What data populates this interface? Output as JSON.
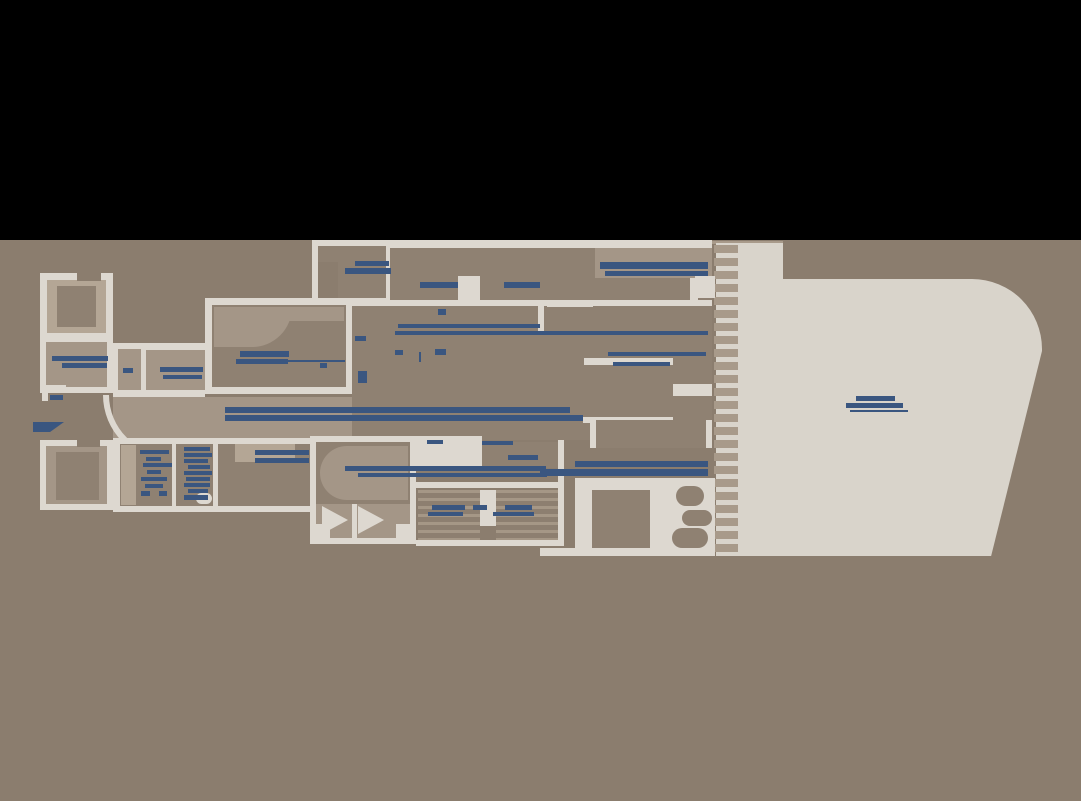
{
  "plan": {
    "kind": "deck-plan-drawing",
    "readable_text": "",
    "note_label_text_illegible": true
  },
  "colors": {
    "black": "#000000",
    "field": "#8b7d6e",
    "wall": "#ddd8d0",
    "deck": "#d9d4cb",
    "floor-a": "#92846f",
    "floor-a2": "#8f8172",
    "floor-b": "#a49687",
    "floor-c": "#b4a695",
    "tape": "#a89a8a",
    "accent": "#3a5680"
  },
  "label_bars": [
    {
      "x": 52,
      "y": 356,
      "w": 56,
      "h": 5
    },
    {
      "x": 62,
      "y": 363,
      "w": 45,
      "h": 5
    },
    {
      "x": 123,
      "y": 368,
      "w": 10,
      "h": 5
    },
    {
      "x": 160,
      "y": 367,
      "w": 43,
      "h": 5
    },
    {
      "x": 163,
      "y": 375,
      "w": 39,
      "h": 4
    },
    {
      "x": 50,
      "y": 395,
      "w": 13,
      "h": 5
    },
    {
      "x": 33,
      "y": 422,
      "w": 31,
      "h": 10,
      "slant": true
    },
    {
      "x": 240,
      "y": 351,
      "w": 49,
      "h": 6
    },
    {
      "x": 236,
      "y": 359,
      "w": 52,
      "h": 5
    },
    {
      "x": 288,
      "y": 360,
      "w": 57,
      "h": 2
    },
    {
      "x": 355,
      "y": 261,
      "w": 34,
      "h": 5
    },
    {
      "x": 345,
      "y": 268,
      "w": 46,
      "h": 6
    },
    {
      "x": 600,
      "y": 262,
      "w": 108,
      "h": 7
    },
    {
      "x": 605,
      "y": 271,
      "w": 103,
      "h": 5
    },
    {
      "x": 420,
      "y": 282,
      "w": 38,
      "h": 6
    },
    {
      "x": 504,
      "y": 282,
      "w": 36,
      "h": 6
    },
    {
      "x": 398,
      "y": 324,
      "w": 142,
      "h": 4
    },
    {
      "x": 395,
      "y": 331,
      "w": 313,
      "h": 4
    },
    {
      "x": 438,
      "y": 309,
      "w": 8,
      "h": 6
    },
    {
      "x": 355,
      "y": 336,
      "w": 11,
      "h": 5
    },
    {
      "x": 395,
      "y": 350,
      "w": 8,
      "h": 5
    },
    {
      "x": 435,
      "y": 349,
      "w": 11,
      "h": 6
    },
    {
      "x": 419,
      "y": 352,
      "w": 2,
      "h": 10
    },
    {
      "x": 358,
      "y": 371,
      "w": 9,
      "h": 12
    },
    {
      "x": 320,
      "y": 363,
      "w": 7,
      "h": 5
    },
    {
      "x": 608,
      "y": 352,
      "w": 98,
      "h": 4
    },
    {
      "x": 613,
      "y": 362,
      "w": 57,
      "h": 4
    },
    {
      "x": 225,
      "y": 407,
      "w": 345,
      "h": 6
    },
    {
      "x": 225,
      "y": 415,
      "w": 358,
      "h": 6
    },
    {
      "x": 575,
      "y": 461,
      "w": 133,
      "h": 6
    },
    {
      "x": 540,
      "y": 469,
      "w": 168,
      "h": 7
    },
    {
      "x": 345,
      "y": 466,
      "w": 201,
      "h": 5
    },
    {
      "x": 358,
      "y": 473,
      "w": 189,
      "h": 4
    },
    {
      "x": 140,
      "y": 450,
      "w": 29,
      "h": 4
    },
    {
      "x": 146,
      "y": 457,
      "w": 15,
      "h": 4
    },
    {
      "x": 143,
      "y": 463,
      "w": 29,
      "h": 4
    },
    {
      "x": 147,
      "y": 470,
      "w": 14,
      "h": 4
    },
    {
      "x": 141,
      "y": 477,
      "w": 26,
      "h": 4
    },
    {
      "x": 145,
      "y": 484,
      "w": 18,
      "h": 4
    },
    {
      "x": 141,
      "y": 491,
      "w": 9,
      "h": 5
    },
    {
      "x": 159,
      "y": 491,
      "w": 8,
      "h": 5
    },
    {
      "x": 184,
      "y": 447,
      "w": 26,
      "h": 4
    },
    {
      "x": 184,
      "y": 453,
      "w": 28,
      "h": 4
    },
    {
      "x": 184,
      "y": 459,
      "w": 24,
      "h": 4
    },
    {
      "x": 188,
      "y": 465,
      "w": 22,
      "h": 4
    },
    {
      "x": 184,
      "y": 471,
      "w": 28,
      "h": 4
    },
    {
      "x": 186,
      "y": 477,
      "w": 24,
      "h": 4
    },
    {
      "x": 184,
      "y": 483,
      "w": 26,
      "h": 4
    },
    {
      "x": 188,
      "y": 489,
      "w": 20,
      "h": 4
    },
    {
      "x": 184,
      "y": 495,
      "w": 24,
      "h": 5
    },
    {
      "x": 255,
      "y": 450,
      "w": 54,
      "h": 5
    },
    {
      "x": 255,
      "y": 458,
      "w": 54,
      "h": 5
    },
    {
      "x": 508,
      "y": 455,
      "w": 30,
      "h": 5
    },
    {
      "x": 432,
      "y": 505,
      "w": 33,
      "h": 5
    },
    {
      "x": 473,
      "y": 505,
      "w": 14,
      "h": 5
    },
    {
      "x": 505,
      "y": 505,
      "w": 27,
      "h": 5
    },
    {
      "x": 428,
      "y": 512,
      "w": 35,
      "h": 4
    },
    {
      "x": 493,
      "y": 512,
      "w": 41,
      "h": 4
    },
    {
      "x": 427,
      "y": 440,
      "w": 16,
      "h": 4
    },
    {
      "x": 482,
      "y": 441,
      "w": 31,
      "h": 4
    },
    {
      "x": 856,
      "y": 396,
      "w": 39,
      "h": 5
    },
    {
      "x": 846,
      "y": 403,
      "w": 57,
      "h": 5
    },
    {
      "x": 850,
      "y": 410,
      "w": 58,
      "h": 2
    }
  ],
  "comb": {
    "tooth_height_px": 8,
    "cycle_px": 13
  },
  "stairs": {
    "flights": 2,
    "tread_cycle_px": 8
  }
}
